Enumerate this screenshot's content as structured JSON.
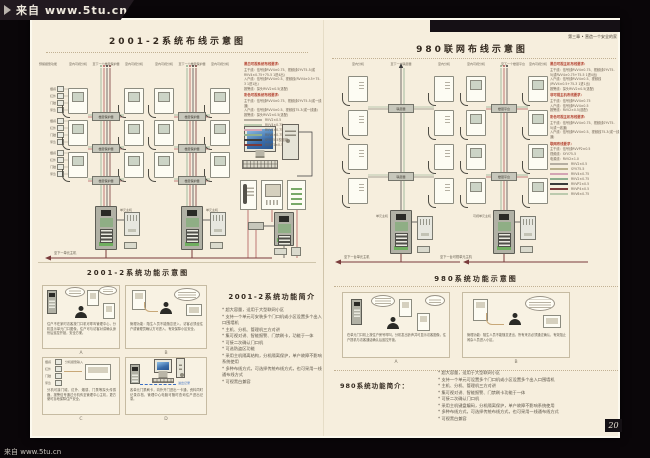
{
  "watermark": {
    "top": "来自 www.5tu.cn",
    "bottom": "来自 www.5tu.cn"
  },
  "chapter_header": "第三章 • 营造一个安全的家",
  "page_number": "20",
  "left_page": {
    "wiring_title": "2001-2系统布线示意图",
    "function_title": "2001-2系统功能示意图",
    "diagram": {
      "column_headers": [
        "预留报警功能",
        "室内可视分机",
        "至下一个楼层保护器",
        "室内可视分机",
        "室内可视分机",
        "至下一个楼层保护器",
        "室内可视分机"
      ],
      "sensor_labels": [
        "烟感",
        "红外",
        "门磁",
        "紧急"
      ],
      "junction_label": "楼层保护器",
      "station_label": "单元主机",
      "bus_label": "至下一单元主机"
    },
    "legend": {
      "sections": [
        {
          "title": "黑白可视系统布线要求：",
          "lines": [
            "主干线：信号线RVV4×0.75、视频线SYV75-5(或RVV4×0.75+75-5 1进4出)",
            "入户线：信号线RVV4×0.5、视频线(RVV4×0.5+75-3 1进1出)",
            "报警线：探头RVV2×0.5(选配)"
          ]
        },
        {
          "title": "彩色可视系统布线要求：",
          "lines": [
            "主干线：信号线RVV4×0.75、视频线SYV75-5(或一线通)",
            "入户线：信号线RVV4×0.5、视频线75-3(或一线通)",
            "报警线：探头RVV2×0.5(选配)"
          ]
        }
      ],
      "wires": [
        {
          "label": "RVV2×0.5",
          "color": "#b6afa2"
        },
        {
          "label": "RVV4×0.75",
          "color": "#bccaae"
        },
        {
          "label": "RVV4×0.75",
          "color": "#d4a4b4"
        },
        {
          "label": "RVV6×0.75",
          "color": "#8fae8f"
        },
        {
          "label": "SYV75-5视频线",
          "color": "#3a3a3a"
        },
        {
          "label": "RVVP2×0.5",
          "color": "#7a3b3b"
        }
      ]
    },
    "panels": [
      {
        "id": "A",
        "caption": "住户不在家时访客按门口机可呼叫管理中心，分机显示单元门口图像，住户可与访客对讲确认身份后遥控开锁，安全方便。"
      },
      {
        "id": "B",
        "caption": "管理功能：陌生人员不能随意进入，访客必须经住户或管理员确认方可进入，有效保障小区安全。"
      },
      {
        "id": "C",
        "caption": "分机可接门磁、红外、烟感、门禁等探头传感器，报警信号通过分机传至管理中心主机，更方便可靠地保障住户安全。",
        "tag": "分机报警输入"
      },
      {
        "id": "D",
        "caption": "各单元门禁刷卡，向外开门进出一卡通，资料同时记录存档，管理中心电脑可随时查询住户进出记录。",
        "tag": "进出记录"
      }
    ],
    "intro": {
      "title": "2001-2系统功能简介",
      "bullets": [
        "超大容量，适用于大型联网小区",
        "支持一个单元可安装多个门口机或小区设置多个出入口围墙机",
        "主机、分机、管理机三方对讲",
        "集可视对讲、智能报警、门禁刷卡，功能于一体",
        "可接二次确认门口机",
        "可选防盗区功能",
        "采用主机隔离结构，分机隔离保护，单户故障不影响系统使用",
        "多种布线方式，可选择传统布线方式，也可采用一线通布线方式",
        "可视黑白兼容"
      ]
    }
  },
  "right_page": {
    "wiring_title": "980联网布线示意图",
    "function_title": "980系统功能示意图",
    "diagram": {
      "column_headers": [
        "室内分机",
        "至下一个联层器",
        "室内分机",
        "室内可视分机",
        "至下一个楼层平台",
        "室内可视分机"
      ],
      "junction_label_1": "联层器",
      "junction_label_2": "楼层平台",
      "station_label_1": "单元主机",
      "station_label_2": "可视单元主机",
      "bus_label_1": "至下一台单元主机",
      "bus_label_2": "至下一台可视单元主机"
    },
    "legend": {
      "sections": [
        {
          "title": "黑白可视主机布线要求：",
          "lines": [
            "主干线：信号线RVV4×0.75、视频线SYV75-5(或RVV4×0.75+75-5 1进4出)",
            "入户线：信号线RVV4×0.5、视频线(RVV4×0.5+75-3 1进1出)",
            "报警线：探头RVV2×0.5(选配)"
          ]
        },
        {
          "title": "非可视主机布线要求：",
          "lines": [
            "主干线：信号线RVV4×0.75",
            "入户线：信号线RVV4×0.5",
            "报警线：RVV2×0.5(选配)"
          ]
        },
        {
          "title": "彩色可视主机布线要求：",
          "lines": [
            "主干线：信号线RVV4×0.75、视频线SYV75-5(或一线通)",
            "入户线：信号线RVV4×0.5、视频线75-3(或一线通)"
          ]
        },
        {
          "title": "联网布线要求：",
          "lines": [
            "主干线：信号线RVVP2×0.5",
            "视频线：SYV75-5",
            "电源线：RVV2×1.0"
          ]
        }
      ],
      "wires": [
        {
          "label": "RVV2×0.5",
          "color": "#b6afa2"
        },
        {
          "label": "SYV75-5",
          "color": "#b9b08e"
        },
        {
          "label": "RVV4×0.75",
          "color": "#d4a4b4"
        },
        {
          "label": "RVV2×0.75",
          "color": "#8fae8f"
        },
        {
          "label": "RVVP2×0.5",
          "color": "#3a3a3a"
        },
        {
          "label": "RVVP4×0.5",
          "color": "#7a3b3b"
        },
        {
          "label": "RVV6×0.75",
          "color": "#bccaae"
        }
      ]
    },
    "panels": [
      {
        "id": "A",
        "caption": "在单元门口机上按住户房号呼叫，分机发出铃声并可显示访客图像，住户提机与访客通话确认后遥控开锁。"
      },
      {
        "id": "B",
        "caption": "管理功能：陌生人员不能随意进出，所有来访必须通过确认，有效阻止闲杂人员进入小区。"
      }
    ],
    "intro": {
      "title": "980系统功能简介：",
      "bullets": [
        "超大容量，适用于大型联网小区",
        "支持一个单元可设置多个门口机或小区设置多个出入口围墙机",
        "主机、分机、管理机三方对讲",
        "集可视对讲、智能报警、门禁刷卡功能于一体",
        "可接二次确认门口机",
        "采用主机键盘编码，分机隔离保护，单户故障不影响系统使用",
        "多种布线方式，可选择传统布线方式，也可采用一线通布线方式",
        "可视黑白兼容"
      ]
    }
  }
}
